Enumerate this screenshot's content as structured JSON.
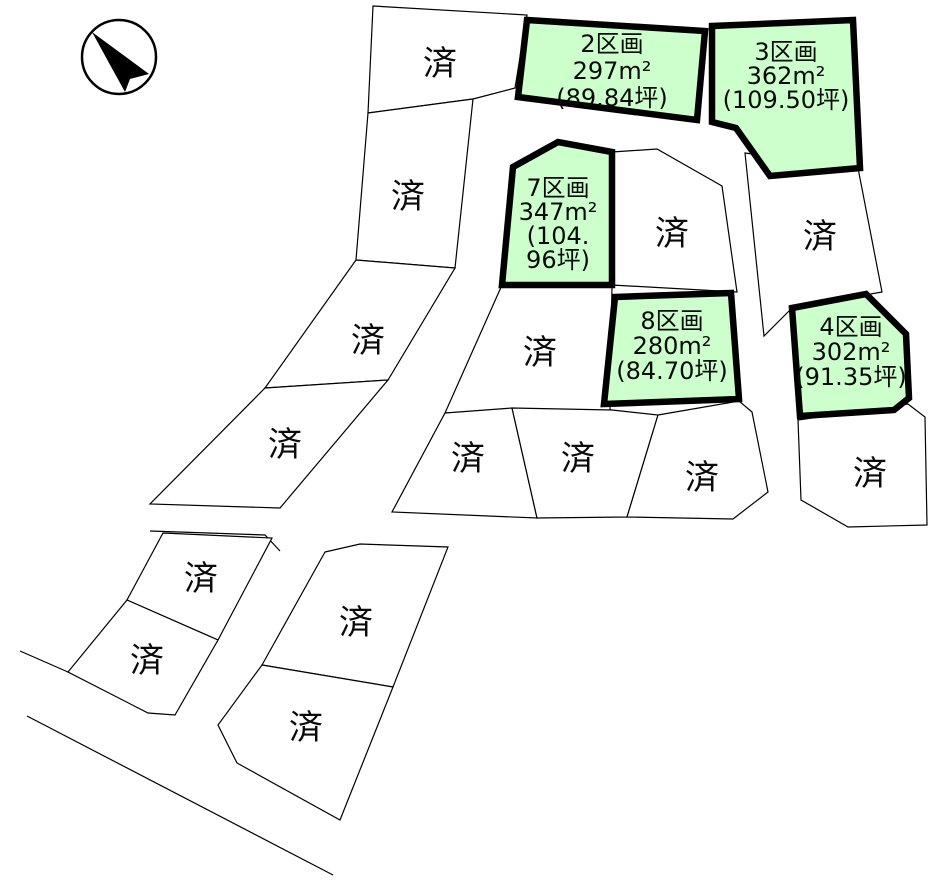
{
  "title": "land-plot-layout-map",
  "colors": {
    "background": "#ffffff",
    "boundary_line": "#000000",
    "available_fill": "#ccffcc",
    "available_border": "#000000",
    "text": "#0a0a0a"
  },
  "compass": {
    "icon": "north-arrow",
    "circle": {
      "cx": 119,
      "cy": 57,
      "r": 37
    },
    "arrow_points": "92,32 149,74 130,79 125,92"
  },
  "sold_label": "済",
  "plots_available": [
    {
      "id": "2",
      "lines": [
        "2区画",
        "297m²",
        "(89.84坪)"
      ],
      "points": "527,20 705,31 697,120 518,97",
      "label_x": 612,
      "label_y": 52,
      "line_height": 27
    },
    {
      "id": "3",
      "lines": [
        "3区画",
        "362m²",
        "(109.50坪)"
      ],
      "points": "712,26 853,20 860,168 770,176 736,128 712,122",
      "label_x": 786,
      "label_y": 60,
      "line_height": 24
    },
    {
      "id": "7",
      "lines": [
        "7区画",
        "347m²",
        "(104.",
        "96坪)"
      ],
      "points": "513,167 558,142 612,152 612,285 502,285",
      "label_x": 558,
      "label_y": 196,
      "line_height": 24
    },
    {
      "id": "8",
      "lines": [
        "8区画",
        "280m²",
        "(84.70坪)"
      ],
      "points": "615,297 731,293 739,399 604,404",
      "label_x": 672,
      "label_y": 329,
      "line_height": 25
    },
    {
      "id": "4",
      "lines": [
        "4区画",
        "302m²",
        "(91.35坪)"
      ],
      "points": "792,308 866,294 906,334 909,398 894,410 800,416",
      "label_x": 851,
      "label_y": 335,
      "line_height": 25
    }
  ],
  "plots_sold": [
    {
      "id": "sold-1",
      "points": "373,6 527,15 515,88 473,99 368,113",
      "label_x": 440,
      "label_y": 75
    },
    {
      "id": "sold-2",
      "points": "368,113 473,99 455,268 356,260",
      "label_x": 408,
      "label_y": 208
    },
    {
      "id": "sold-3",
      "points": "356,260 455,268 388,380 265,388",
      "label_x": 368,
      "label_y": 352
    },
    {
      "id": "sold-4",
      "points": "265,388 388,380 280,508 150,504",
      "label_x": 285,
      "label_y": 456
    },
    {
      "id": "sold-5",
      "points": "612,152 657,149 722,186 737,292 612,285",
      "label_x": 672,
      "label_y": 245
    },
    {
      "id": "sold-6",
      "points": "745,153 858,168 882,292 792,308 764,336",
      "label_x": 820,
      "label_y": 248
    },
    {
      "id": "sold-7",
      "points": "502,285 612,285 610,410 445,413",
      "label_x": 540,
      "label_y": 364
    },
    {
      "id": "sold-8",
      "points": "445,413 512,408 537,518 392,512",
      "label_x": 468,
      "label_y": 470
    },
    {
      "id": "sold-9",
      "points": "512,408 612,410 658,415 627,517 537,518",
      "label_x": 578,
      "label_y": 470
    },
    {
      "id": "sold-10",
      "points": "658,415 739,401 752,412 768,492 733,519 627,517",
      "label_x": 702,
      "label_y": 489
    },
    {
      "id": "sold-11",
      "points": "798,420 908,404 925,417 927,525 848,527 801,500",
      "label_x": 870,
      "label_y": 485
    },
    {
      "id": "sold-12",
      "points": "163,533 272,538 218,640 127,600",
      "label_x": 201,
      "label_y": 590
    },
    {
      "id": "sold-13",
      "points": "127,600 218,640 175,715 148,713 68,672",
      "label_x": 147,
      "label_y": 672
    },
    {
      "id": "sold-14",
      "points": "325,552 360,544 448,547 393,687 262,665",
      "label_x": 356,
      "label_y": 634
    },
    {
      "id": "sold-15",
      "points": "262,665 393,687 340,820 237,763 218,725",
      "label_x": 306,
      "label_y": 739
    }
  ],
  "roads": [
    {
      "id": "road-edge-1",
      "points": "20,651 68,672"
    },
    {
      "id": "road-edge-2",
      "points": "27,716 333,875"
    },
    {
      "id": "road-edge-3",
      "points": "150,531 265,535 280,551"
    }
  ]
}
